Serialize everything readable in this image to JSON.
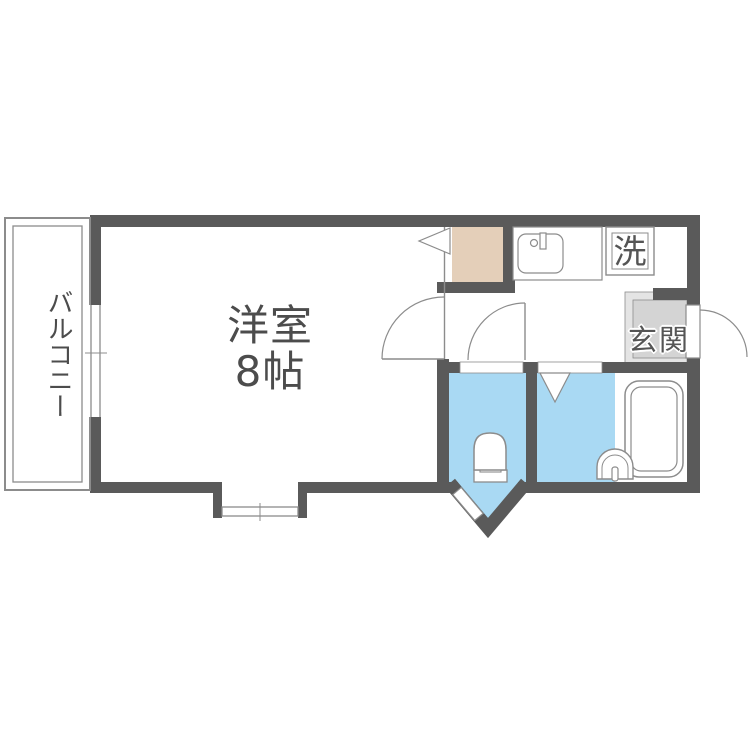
{
  "plan": {
    "rooms": {
      "balcony": {
        "label": "バルコニー"
      },
      "main_room": {
        "label": "洋室",
        "size": "8帖"
      },
      "entrance": {
        "label": "玄関"
      },
      "laundry": {
        "label": "洗"
      }
    },
    "fixtures": {
      "toilet": "toilet-icon",
      "bathtub": "bathtub-icon",
      "kitchen_sink": "kitchen-sink-icon",
      "washbasin": "washbasin-icon",
      "refrigerator_space": "closet-space",
      "doors": [
        "swing-door-arc",
        "folding-door-v",
        "entrance-door-arc"
      ],
      "windows": [
        "balcony-window",
        "bay-window",
        "toilet-corner-window"
      ]
    },
    "colors": {
      "wall": "#5a5a5a",
      "line": "#8c8c8c",
      "water": "#a9d9f3",
      "closet": "#e4cfb9",
      "entrance_outer": "#e4e4e4",
      "entrance_inner": "#d4d4d4",
      "label": "#4c4c4c",
      "background": "#ffffff"
    }
  }
}
